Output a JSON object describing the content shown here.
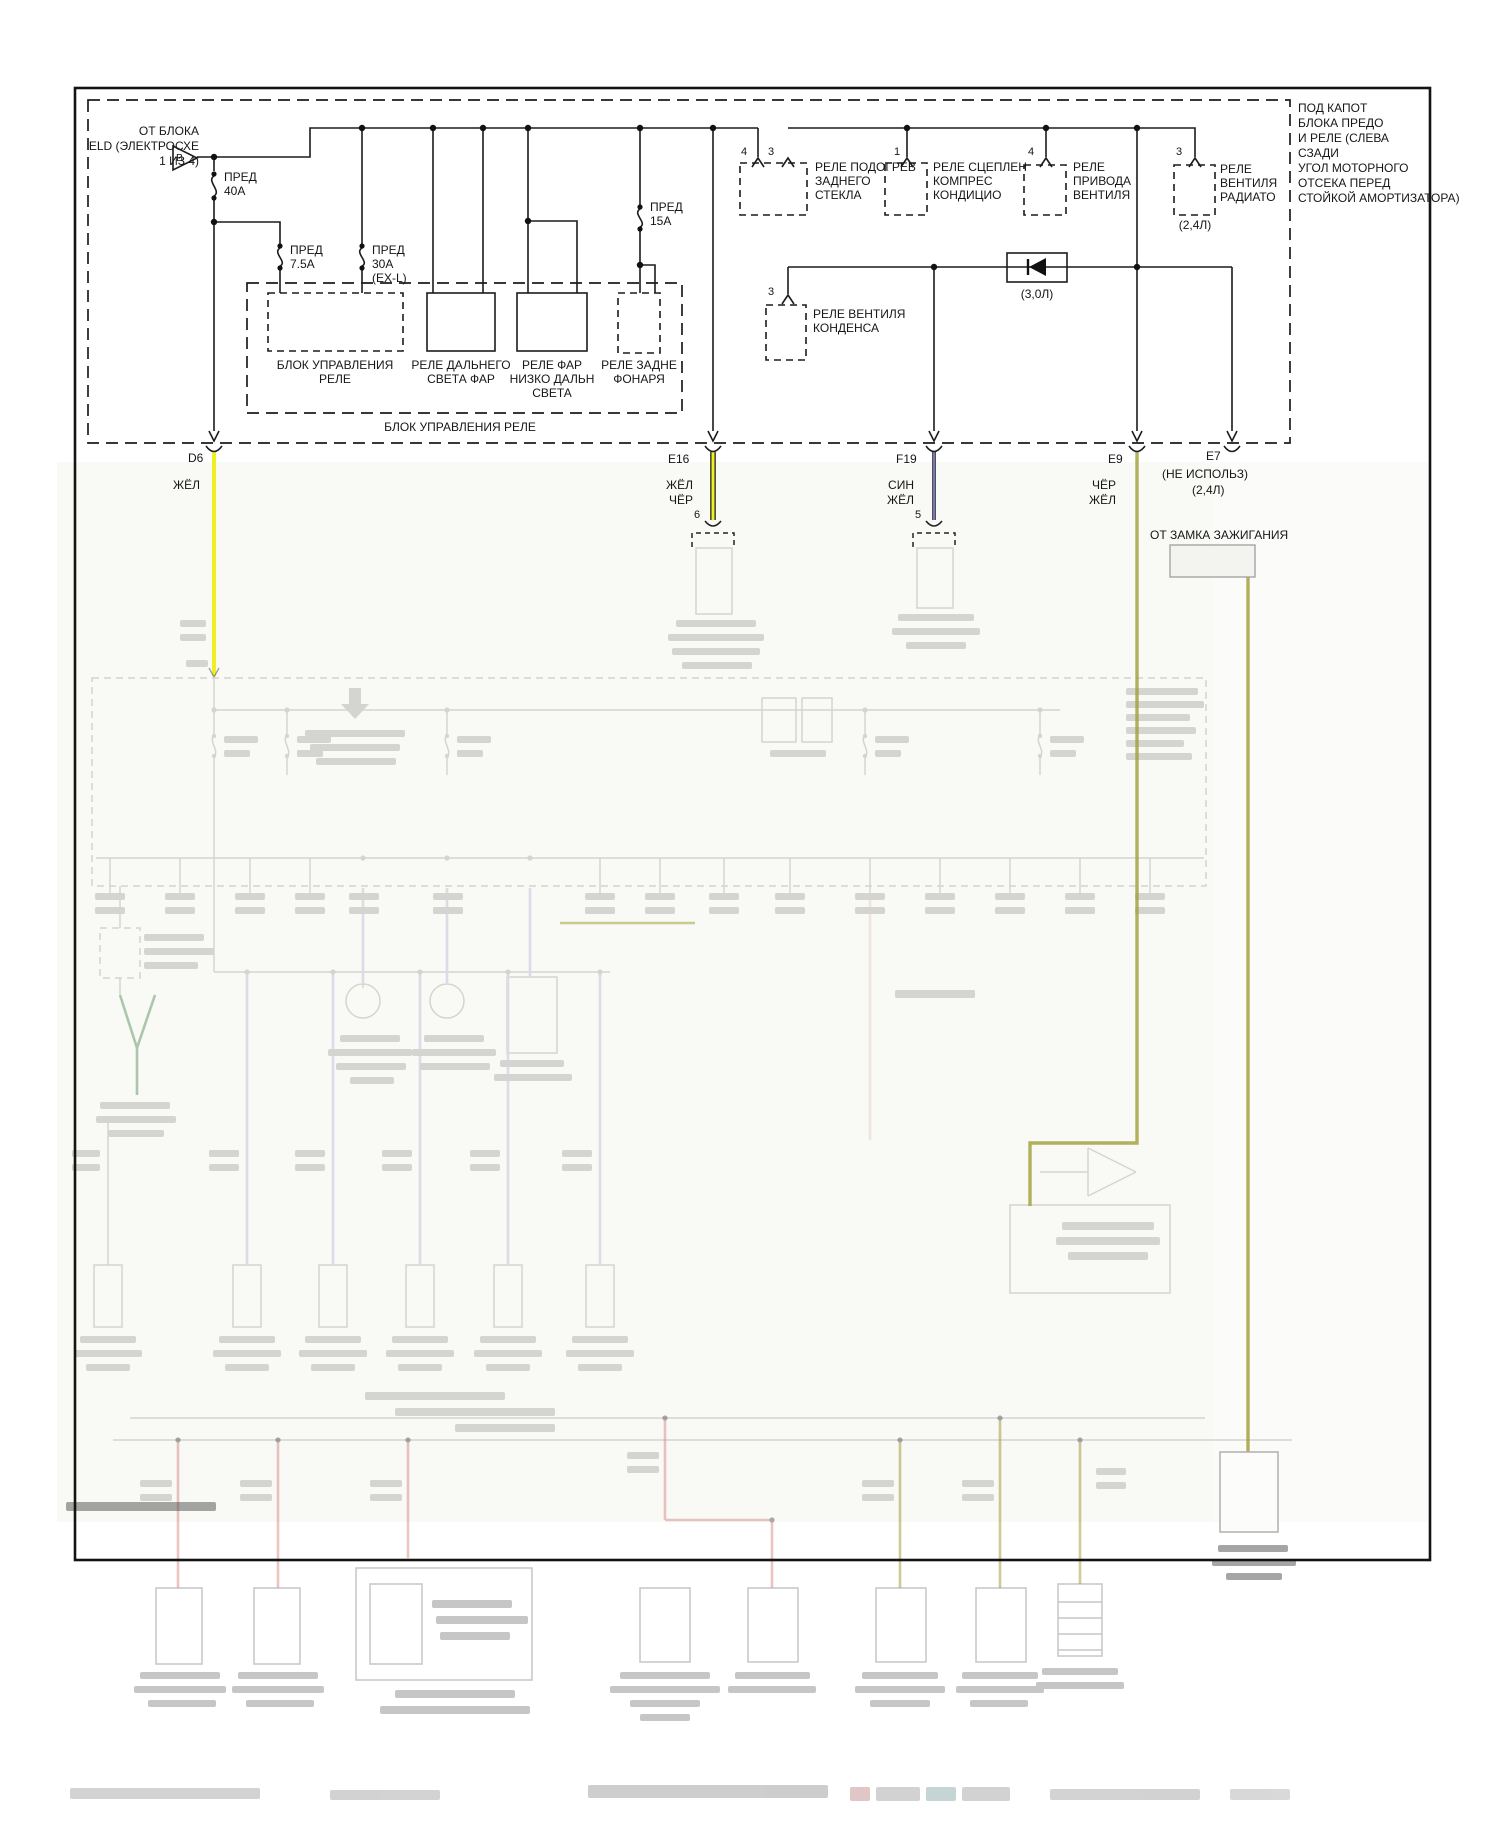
{
  "diagram": {
    "header_note": [
      "ПОД КАПОТ",
      "БЛОКА ПРЕДО",
      "И РЕЛЕ (СЛЕВА",
      "СЗАДИ",
      "УГОЛ МОТОРНОГО",
      "ОТСЕКА ПЕРЕД",
      "СТОЙКОЙ АМОРТИЗАТОРА)"
    ],
    "source": {
      "lines": [
        "ОТ БЛОКА",
        "ELD (ЭЛЕКТРОСХЕ",
        "1 ИЗ 4)"
      ],
      "tag": "B"
    },
    "fuses": {
      "f40": {
        "lines": [
          "ПРЕД",
          "40А"
        ]
      },
      "f75": {
        "lines": [
          "ПРЕД",
          "7.5А"
        ]
      },
      "f30": {
        "lines": [
          "ПРЕД",
          "30А",
          "(EX-L)"
        ]
      },
      "f15": {
        "lines": [
          "ПРЕД",
          "15А"
        ]
      }
    },
    "relay_box": {
      "label": "БЛОК УПРАВЛЕНИЯ РЕЛЕ",
      "units": [
        {
          "lines": [
            "БЛОК УПРАВЛЕНИЯ",
            "РЕЛЕ"
          ]
        },
        {
          "lines": [
            "РЕЛЕ ДАЛЬНЕГО",
            "СВЕТА ФАР"
          ]
        },
        {
          "lines": [
            "РЕЛЕ ФАР",
            "НИЗКО ДАЛЬН",
            "СВЕТА"
          ]
        },
        {
          "lines": [
            "РЕЛЕ ЗАДНЕ",
            "ФОНАРЯ"
          ]
        }
      ]
    },
    "relays": [
      {
        "pins": [
          "4",
          "3"
        ],
        "lines": [
          "РЕЛЕ ПОДОГРЕВ",
          "ЗАДНЕГО",
          "СТЕКЛА"
        ]
      },
      {
        "pins": [
          "1"
        ],
        "lines": [
          "РЕЛЕ СЦЕПЛЕН",
          "КОМПРЕС",
          "КОНДИЦИО"
        ]
      },
      {
        "pins": [
          "4"
        ],
        "lines": [
          "РЕЛЕ",
          "ПРИВОДА",
          "ВЕНТИЛЯ"
        ]
      },
      {
        "pins": [
          "3"
        ],
        "lines": [
          "РЕЛЕ",
          "ВЕНТИЛЯ",
          "РАДИАТО"
        ],
        "note": "(2,4Л)"
      },
      {
        "pins": [
          "3"
        ],
        "lines": [
          "РЕЛЕ ВЕНТИЛЯ",
          "КОНДЕНСА"
        ]
      }
    ],
    "diode_note": "(3,0Л)",
    "connectors": {
      "d6": {
        "id": "D6",
        "wire": [
          "ЖЁЛ"
        ]
      },
      "e16": {
        "id": "E16",
        "wire": [
          "ЖЁЛ",
          "ЧЁР"
        ],
        "pin": "6"
      },
      "f19": {
        "id": "F19",
        "wire": [
          "СИН",
          "ЖЁЛ"
        ],
        "pin": "5"
      },
      "e9": {
        "id": "E9",
        "wire": [
          "ЧЁР",
          "ЖЁЛ"
        ]
      },
      "e7": {
        "id": "E7",
        "note1": "(НЕ ИСПОЛЬЗ)",
        "note2": "(2,4Л)"
      }
    },
    "ignition_label": "ОТ ЗАМКА ЗАЖИГАНИЯ",
    "colors": {
      "yellow": "#eff021",
      "blue": "#32329b",
      "olive": "#a0a03a"
    }
  }
}
